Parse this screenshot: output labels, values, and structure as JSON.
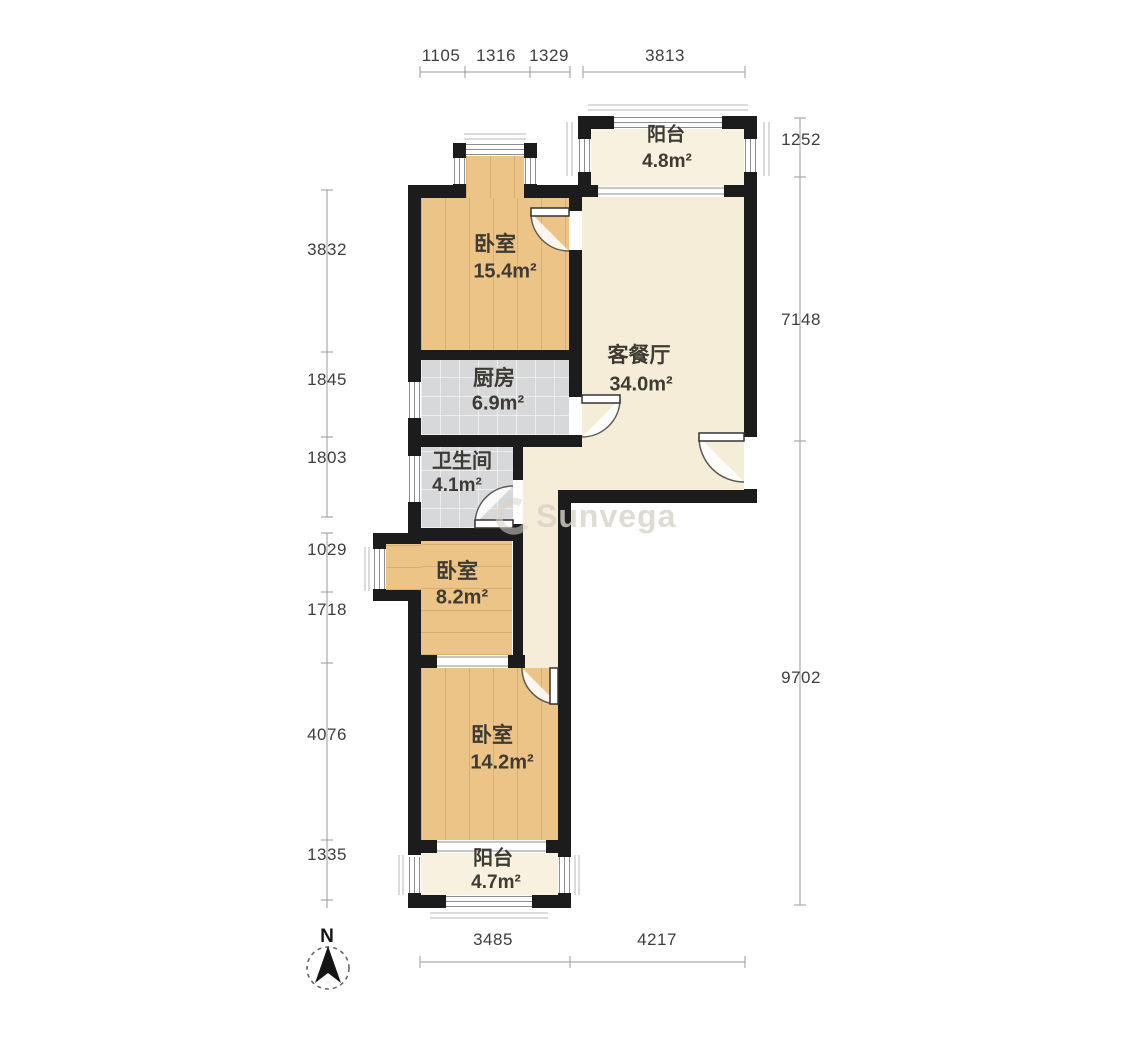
{
  "plan": {
    "rooms": [
      {
        "id": "balcony-top",
        "name": "阳台",
        "area": "4.8m²"
      },
      {
        "id": "bedroom-north",
        "name": "卧室",
        "area": "15.4m²"
      },
      {
        "id": "living-dining",
        "name": "客餐厅",
        "area": "34.0m²"
      },
      {
        "id": "kitchen",
        "name": "厨房",
        "area": "6.9m²"
      },
      {
        "id": "bathroom",
        "name": "卫生间",
        "area": "4.1m²"
      },
      {
        "id": "bedroom-middle",
        "name": "卧室",
        "area": "8.2m²"
      },
      {
        "id": "bedroom-south",
        "name": "卧室",
        "area": "14.2m²"
      },
      {
        "id": "balcony-bottom",
        "name": "阳台",
        "area": "4.7m²"
      }
    ],
    "dimensions": {
      "top": [
        "1105",
        "1316",
        "1329",
        "3813"
      ],
      "left": [
        "3832",
        "1845",
        "1803",
        "1029",
        "1718",
        "4076",
        "1335"
      ],
      "right": [
        "1252",
        "7148",
        "9702"
      ],
      "bottom": [
        "3485",
        "4217"
      ]
    },
    "compass": {
      "label": "N"
    },
    "watermark": {
      "text": "Sunvega"
    }
  },
  "colors": {
    "wall": "#1c1c1c",
    "wood_floor": "#edc487",
    "tile_floor": "#d7d8da",
    "living_floor": "#f5edd8",
    "balcony_floor": "#f8f1df",
    "dimension_text": "#3e3e3e",
    "watermark_text": "#d8d4c6"
  }
}
